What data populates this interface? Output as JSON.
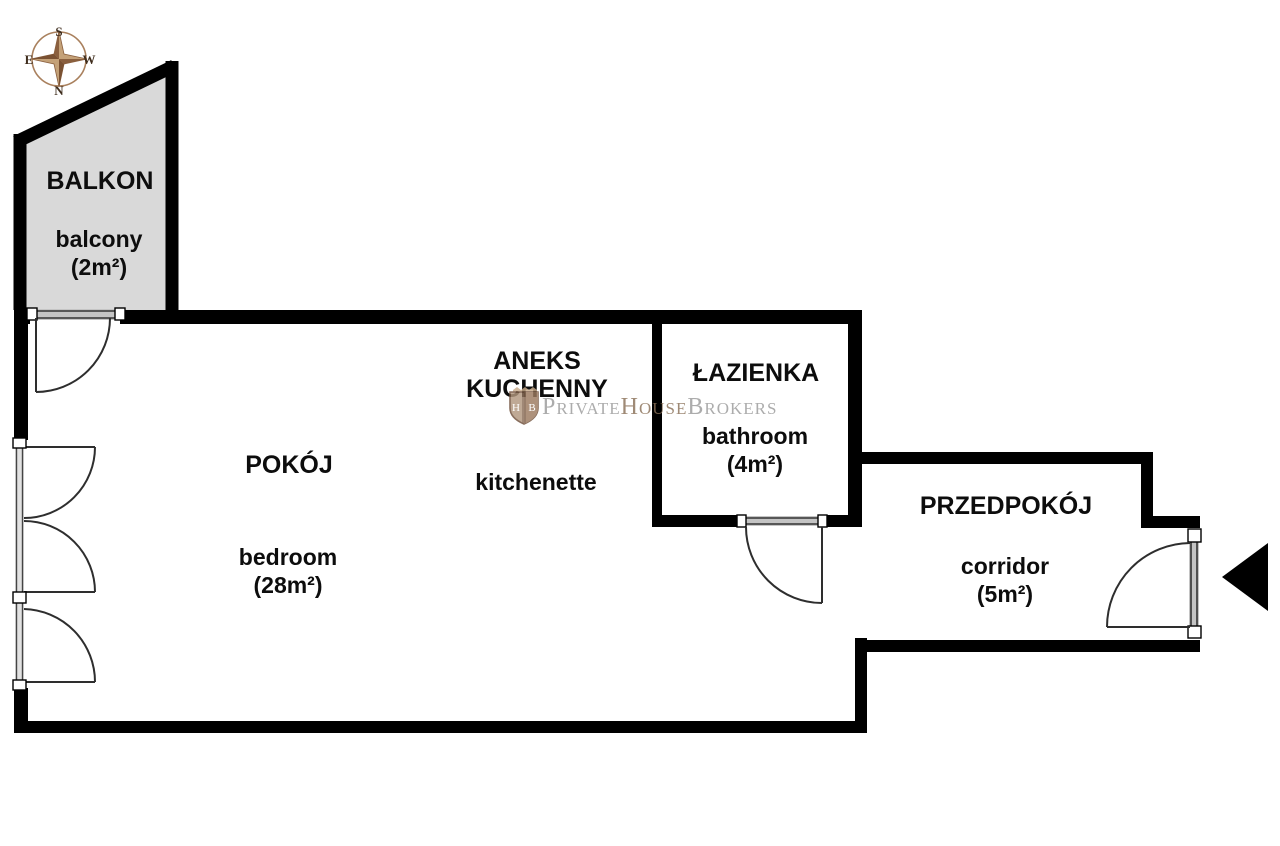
{
  "compass": {
    "north": "N",
    "south": "S",
    "east": "E",
    "west": "W"
  },
  "rooms": {
    "balcony": {
      "name_pl": "BALKON",
      "name_en": "balcony",
      "area": "(2m²)"
    },
    "bedroom": {
      "name_pl": "POKÓJ",
      "name_en": "bedroom",
      "area": "(28m²)"
    },
    "kitchenette": {
      "name_pl_line1": "ANEKS",
      "name_pl_line2": "KUCHENNY",
      "name_en": "kitchenette"
    },
    "bathroom": {
      "name_pl": "ŁAZIENKA",
      "name_en": "bathroom",
      "area": "(4m²)"
    },
    "corridor": {
      "name_pl": "PRZEDPOKÓJ",
      "name_en": "corridor",
      "area": "(5m²)"
    }
  },
  "watermark": {
    "brand_part1": "Private",
    "brand_part2": "House",
    "brand_part3": "Brokers",
    "shield_letter_left": "H",
    "shield_letter_right": "B"
  },
  "colors": {
    "wall": "#000000",
    "balcony_fill": "#d9d9d9",
    "door_stroke": "#333333",
    "threshold_fill": "#c4c4c4",
    "compass_ring": "#a9805d",
    "compass_star_light": "#c4a178",
    "compass_star_dark": "#8a5f3e",
    "compass_letters": "#3f2d1d",
    "watermark_gray": "#9b9b9b",
    "watermark_brown": "#8a7158",
    "entrance_arrow": "#000000"
  }
}
